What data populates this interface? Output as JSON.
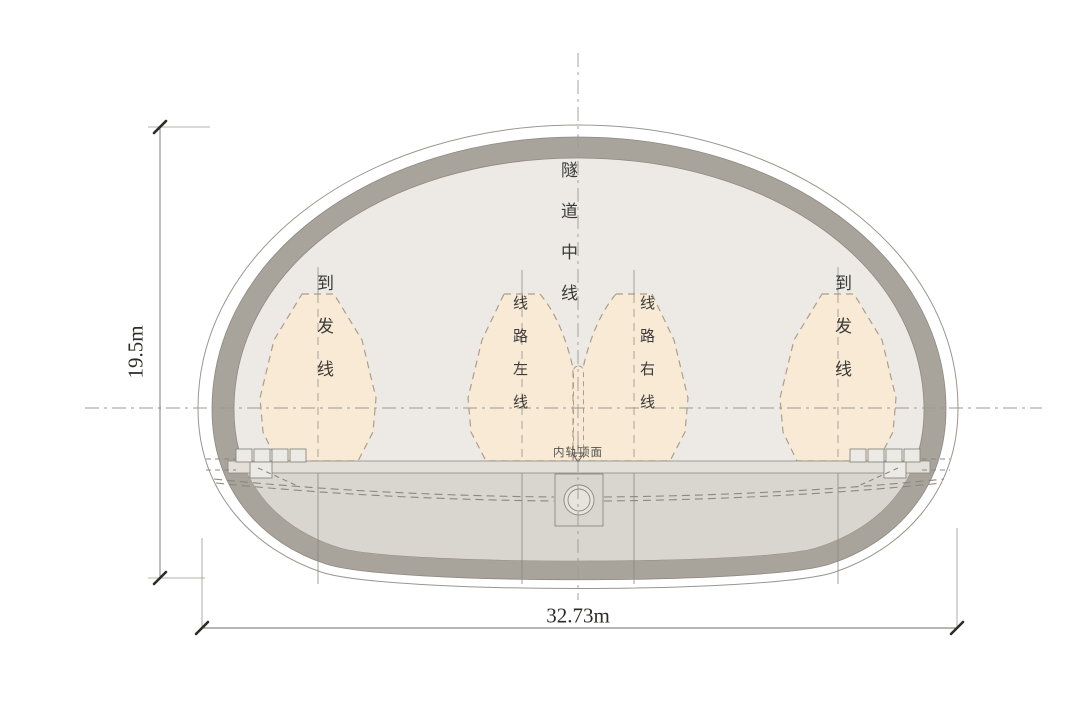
{
  "diagram_type": "tunnel-cross-section",
  "labels": {
    "tunnel_centerline": "隧道中线",
    "arrival_departure_left": "到发线",
    "main_line_left": "线路左线",
    "main_line_right": "线路右线",
    "arrival_departure_right": "到发线",
    "inner_rail_top_surface": "内轨顶面"
  },
  "dimensions": {
    "height_label": "19.5m",
    "width_label": "32.73m"
  },
  "colors": {
    "bg": "#ffffff",
    "lining-gray": "#a8a49c",
    "interior-fill": "#edeae5",
    "invert-fill": "#d9d6cf",
    "slab-fill": "#e3e0d9",
    "envelope-fill": "#f8ead5",
    "envelope-stroke": "#ab9f8b",
    "line-gray": "#8b8880",
    "centerline-gray": "#9a9a94",
    "dim-color": "#555555",
    "text-color": "#3a3a38"
  }
}
